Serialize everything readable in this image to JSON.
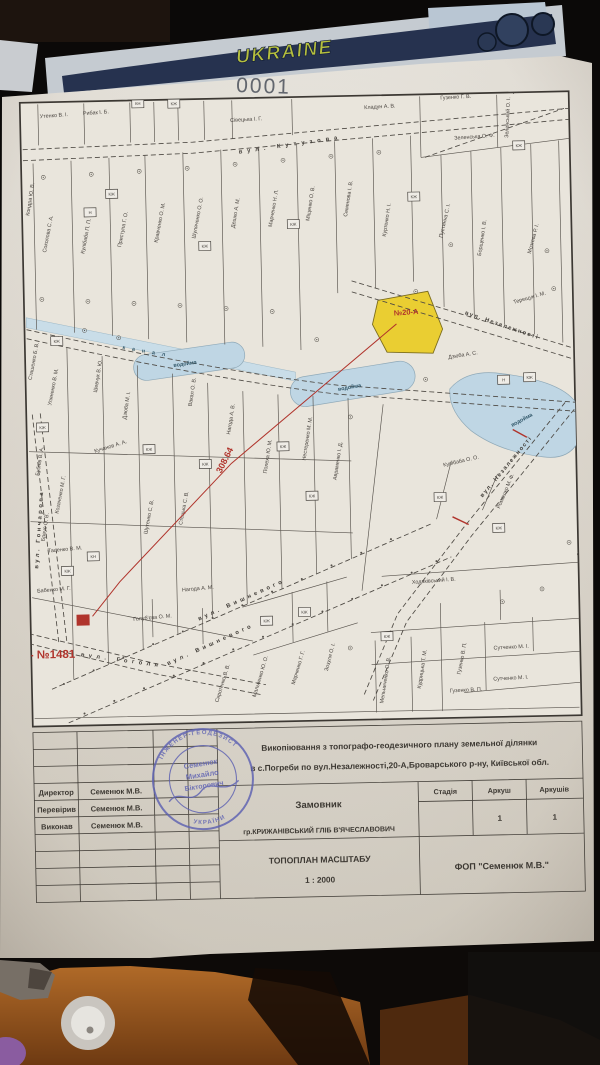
{
  "page_number": "0001",
  "sticker": {
    "text": "UKRAINE"
  },
  "map": {
    "annotations": {
      "parcel_number": "№20-А",
      "distance": "308.64",
      "substation": "ТП - №1481"
    },
    "canal_label": "канал",
    "water_labels": [
      "водойма",
      "водойма",
      "водойма"
    ],
    "streets": [
      "вул. Кутузова",
      "вул. Незалежності",
      "вул. Незалежності",
      "вул. Вишневого",
      "вул. Вишневого",
      "вул. Гоголя",
      "вул. Гончарова"
    ],
    "owners": [
      "Утенко В. І.",
      "Рибак І. Б.",
      "Сівецька І. Г.",
      "Кладун А. В.",
      "Гузенко Г. В.",
      "Гузенко Г. В.",
      "Зеленська О. Ф.",
      "Зеленський О. І.",
      "Терещук І. М.",
      "Кондра Ю. В.",
      "Соколова С. А.",
      "Кулібаба П. П.",
      "Приступа Г. О.",
      "Кравченко О. М.",
      "Шуляченко О. О.",
      "Дешко А. М.",
      "Марченко Н. Л.",
      "Міщенко О. В.",
      "Семенова І. В.",
      "Куртенко Н. І.",
      "Пустинна С. І.",
      "Борщенко І. В.",
      "Мозгова Р. І.",
      "Уляненко В. М.",
      "Шевчук В. Ю.",
      "Дзюба М. І.",
      "Вакал О. В.",
      "Нагода А. В.",
      "Сташенко Б. В.",
      "Дзюба А. С.",
      "Кулібаба О. О.",
      "Ромашко М. Ф.",
      "Козаченко М. Г.",
      "Бубнів В. А.",
      "Бреус О. В.",
      "Таценко В. М.",
      "Бабенко М. Г.",
      "Голуб'єва О. М.",
      "Нагода А. М.",
      "Сиротенко В. В.",
      "Мальченко Ю. О.",
      "Марченко Г. Г.",
      "Зозуля О. І.",
      "Гузенко В. П.",
      "Гузенко В. П.",
      "Сутченко М. І.",
      "Сутченко М. І.",
      "Кудрицька Т. М.",
      "Мельниченко О. В.",
      "Ходаківський І. В.",
      "Шутенко С. В.",
      "Стецька С. В.",
      "Кучанов А. А.",
      "Полеха Ю. М.",
      "Нестеренко М. М.",
      "Авраменко І. Д."
    ],
    "buildings": [
      "КН",
      "КЖ",
      "КЖ",
      "Н",
      "КЖ",
      "КЖ",
      "КЖ",
      "КЖ",
      "КЖ",
      "КЖ",
      "КЖ",
      "КЖ",
      "КЖ",
      "КЖ",
      "КЖ",
      "КЖ",
      "Н",
      "КЖ",
      "КЖ",
      "КЖ",
      "КН",
      "КЖ",
      "КЖ"
    ]
  },
  "title_block": {
    "rows": [
      {
        "label": "Директор",
        "value": "Семенюк М.В."
      },
      {
        "label": "Перевірив",
        "value": "Семенюк М.В."
      },
      {
        "label": "Виконав",
        "value": "Семенюк М.В."
      }
    ],
    "subject_line1": "Викопіювання з топографо-геодезичного плану земельної ділянки",
    "subject_line2": "в с.Погреби по вул.Незалежності,20-А,Броварського р-ну, Київської обл.",
    "customer_label": "Замовник",
    "customer_name": "гр.КРИЖАНІВСЬКИЙ ГЛІБ В'ЯЧЕСЛАВОВИЧ",
    "col_stage": "Стадія",
    "col_sheet": "Аркуш",
    "col_sheets": "Аркушів",
    "sheet_value": "1",
    "sheets_value": "1",
    "plan_title": "ТОПОПЛАН МАСШТАБУ",
    "plan_scale": "1 : 2000",
    "organization": "ФОП  \"Семенюк М.В.\""
  },
  "stamp": {
    "line1": "Семенюк",
    "line2": "Михайло",
    "line3": "Вікторович",
    "ring_top": "ІНЖЕНЕР-ГЕОДЕЗИСТ",
    "ring_bottom": "УКРАЇНИ"
  },
  "colors": {
    "paper": "#ddd8cf",
    "map_line": "#56514b",
    "water": "#bfd6e4",
    "highlight_parcel": "#eace32",
    "annotation_red": "#b0342c",
    "stamp_blue": "#5d61b2",
    "wood": "#a85f22",
    "graffiti_bg": "#26324f",
    "graffiti_text": "#aeb83b"
  }
}
